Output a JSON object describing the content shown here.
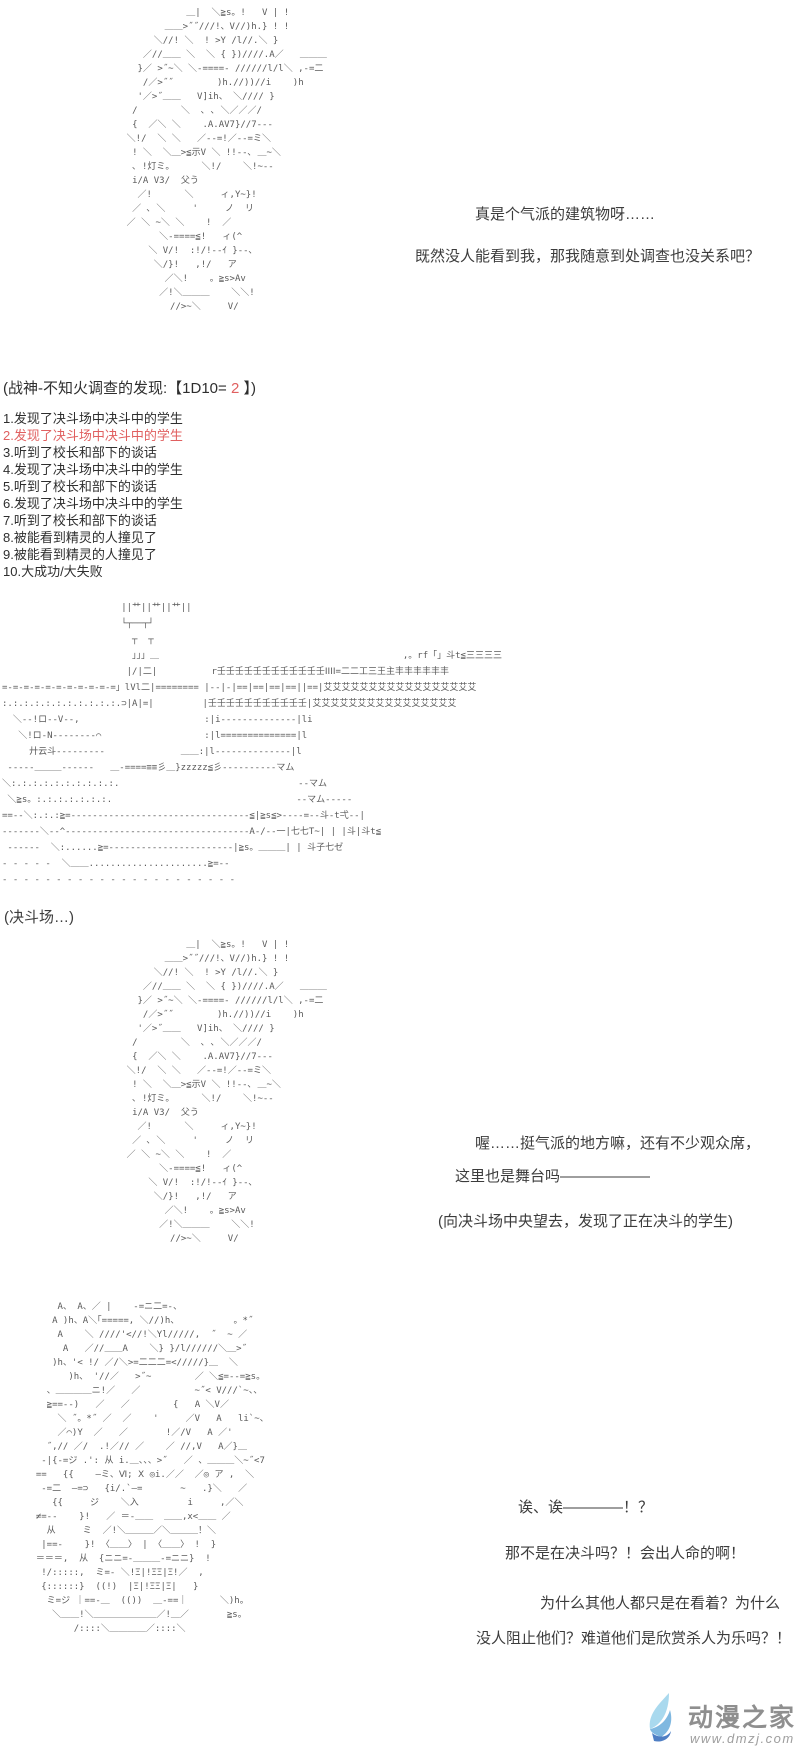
{
  "page": {
    "background": "#ffffff",
    "aa_color": "#5a5a5a",
    "text_color": "#3c3c3c",
    "highlight_red": "#e06060"
  },
  "character_aa": {
    "lines": [
      "               ＿|  ＼≧s。!   V | !",
      "           ＿＿>˝˝///!、V//)h.} ! !",
      "         ＼//! ＼  ! >Y /l//.＼ }",
      "       ／//＿＿ ＼  ＼ { })////.A／   ＿＿＿",
      "      }／ >˝~＼ ＼-====- //////l/l＼ ,-=二",
      "       /／>˝˝        )h.//))//i    )h",
      "      '／>˝＿＿   V]ih、 ＼//// }",
      "     /        ＼  ､ ､ ＼／／／/",
      "     {  ／＼ ＼    .A.AV7}//7---",
      "    ＼!/  ＼ ＼   ／--=!／--=ミ＼",
      "     ! ＼  ＼＿>≦示V ＼ !!--､ ＿~＼",
      "     ､ !灯ミ。     ＼!/    ＼!~--",
      "     i/A V3/  父う",
      "      ／!      ＼     ィ,Y~}!",
      "     ／ ､ ＼     '     ノ  リ",
      "    ／ ＼ ~＼ ＼    !  ／",
      "          ＼-====≦!   ィ(^",
      "        ＼ V/!  :!/!--ｲ }--､",
      "         ＼/}!   ,!/   ア",
      "           ／＼!    。≧s>Av",
      "          ／!＼＿＿＿    ＼＼!",
      "            //>~＼     V/"
    ]
  },
  "scene1": {
    "dialogue1": "真是个气派的建筑物呀……",
    "dialogue2": "既然没人能看到我，那我随意到处调查也没关系吧？"
  },
  "dice": {
    "prefix": "(战神-不知火调查的发现:【1D10=",
    "value": " 2 ",
    "suffix": "】)"
  },
  "result_list": {
    "items": [
      {
        "label": "1.发现了决斗场中决斗中的学生",
        "highlight": false
      },
      {
        "label": "2.发现了决斗场中决斗中的学生",
        "highlight": true
      },
      {
        "label": "3.听到了校长和部下的谈话",
        "highlight": false
      },
      {
        "label": "4.发现了决斗场中决斗中的学生",
        "highlight": false
      },
      {
        "label": "5.听到了校长和部下的谈话",
        "highlight": false
      },
      {
        "label": "6.发现了决斗场中决斗中的学生",
        "highlight": false
      },
      {
        "label": "7.听到了校长和部下的谈话",
        "highlight": false
      },
      {
        "label": "8.被能看到精灵的人撞见了",
        "highlight": false
      },
      {
        "label": "9.被能看到精灵的人撞见了",
        "highlight": false
      },
      {
        "label": "10.大成功/大失败",
        "highlight": false
      }
    ]
  },
  "arena": {
    "caption": "(决斗场…)",
    "aa_lines": [
      "                      ||艹||艹||艹||",
      "                      └┬──┬┘",
      "                        ┬  ┬",
      "                        」」」＿                                             ,。rf「」斗t≦三三三三",
      "                       |/|二|          r壬壬壬壬壬壬壬壬壬壬壬壬ⅠⅠⅠⅠ=二二工三王主丰丰丰丰丰丰",
      "=-=-=-=-=-=-=-=-=-=-=」lVl二|======== |--|-|==|==|==|==||==|艾艾艾艾艾艾艾艾艾艾艾艾艾艾艾艾艾",
      ":.:.:.:.:.:.:.:.:.:.:.⊃|A|=|         |壬壬壬壬壬壬壬壬壬壬壬|艾艾艾艾艾艾艾艾艾艾艾艾艾艾艾艾",
      "  ＼--!ロ--V--,                       :|i--------------|li",
      "   ＼!ロ-N--------⌒                   :|l==============|l",
      "     廾云斗---------              ＿＿:|l--------------|l",
      " -----＿＿＿------   ＿-====≡≡彡＿}zzzzz≦彡----------マム",
      "＼:.:.:.:.:.:.:.:.:.:.                                 --マム",
      " ＼≧s。:.:.:.:.:.:.:.                                  --マム-----",
      "==--＼:.:.:≧=---------------------------------≦|≧s≦>----=--斗-t弌--|",
      "-------＼--^----------------------------------A-/--一|七七T~| | |斗|斗t≦",
      " ------  ＼:......≧=-----------------------|≧s。＿＿＿| | 斗子七ゼ",
      "- - - - -  ＼＿＿......................≧=--",
      "- - - - - - - - - - - - - - - - - - - - - -"
    ]
  },
  "scene2": {
    "dialogue1": "喔……挺气派的地方嘛，还有不少观众席，",
    "dialogue2": "这里也是舞台吗——————",
    "narration": "(向决斗场中央望去，发现了正在决斗的学生)"
  },
  "scene3": {
    "aa_lines": [
      "      A、 A、／ |    -=ニ二=-、",
      "     A )h、A＼｢=====, ＼//)h、          。*˝",
      "      A    ＼ ////'<//!＼Yl/////,  ˝  ~ ／",
      "       A   ／//＿＿A    ＼} }/l//////＼＿>˝",
      "     )h、'< !/ ／/＼>=二二二=</////}＿  ＼",
      "        )h、 '//／   >˝~        ／ ＼≦=--=≧s。",
      "    、＿＿＿＿ニ!／   ／          ~˝< V///`~、、",
      "    ≧==--)   ／   ／        {   A ＼V／",
      "      ＼ ˝。*˝ ／  ／    '     ／V   A   li`~、",
      "      ／⌒)Y  ／   ／       !／/V   A ／'",
      "    ˝,// ／/  .!／// ／    ／ //,V   A／}＿",
      "   -|{-=ジ .': 从 i.＿、、、>˝   ／ 、＿＿＿＼~˝<7",
      "  ==   {{    —ミ、Ⅵ; Ⅹ ◎i.／／  ／◎ ア ,  ＼",
      "   -=二  —=⊃   {i/.`—=       ~   .}＼   ／",
      "     {{     ジ    ＼入         i     ,／＼",
      "  ≠=--    }!   ／ ＝-＿＿  ＿＿,x<＿＿ ／",
      "    从     ミ  ／!＼＿＿＿／＼＿＿＿！＼",
      "   |==-    }! 〈＿＿〉 | 〈＿＿〉 !  }",
      "  ＝＝＝,  从  {ニニ=-＿＿＿-=ニニ}  !",
      "   !/:::::,  ミ=- ＼!Ξ|!ΞΞ|Ξ!／  ,",
      "   {::::::}  ((!)  |Ξ|!ΞΞ|Ξ|   }",
      "    ミ=ジ ｜==-＿  (())  ＿-==｜      ＼)h。",
      "     ＼＿＿!＼＿＿＿＿＿＿＿／!＿／       ≧s。",
      "         /::::＼＿＿＿＿／::::＼"
    ],
    "dialogue1": "诶、诶————！？",
    "dialogue2": "那不是在决斗吗？！会出人命的啊！",
    "dialogue3": "为什么其他人都只是在看着？为什么",
    "dialogue4": "没人阻止他们？难道他们是欣赏杀人为乐吗？！"
  },
  "footer": {
    "site_name": "动漫之家",
    "site_url": "www.dmzj.com",
    "logo_icon": "wing-flame-logo",
    "logo_colors": {
      "light": "#a9d9ee",
      "mid": "#7fb8e0",
      "dark": "#4f7fc4"
    },
    "name_color": "#8f8f8f",
    "url_color": "#9e9e9e"
  }
}
